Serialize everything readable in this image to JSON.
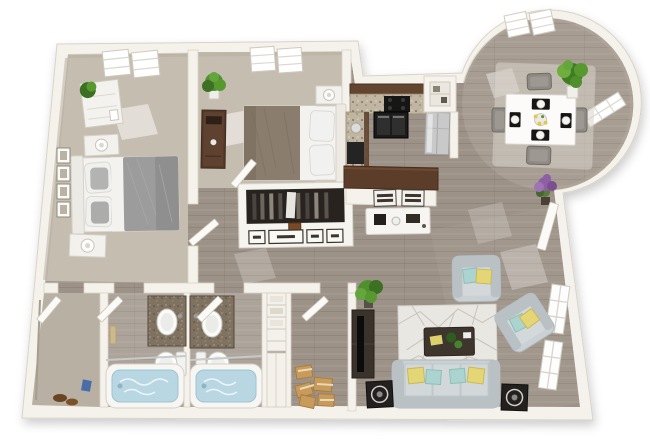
{
  "meta": {
    "description": "3D rendered bird's-eye floor plan of a two-bedroom, two-bathroom apartment with eat-in kitchen, round dining turret, hallway closets and living room",
    "render_style": "photoreal 3D dollhouse floor plan, no text labels"
  },
  "palette": {
    "wall-fill": "#f5f2ec",
    "wall-stroke": "#d9d3c8",
    "wall-face": "#b7afa1",
    "floor-wood": "#9d9287",
    "wood-line": "#837970",
    "carpet": "#c5bdaf",
    "carpet-dark": "#b8b0a2",
    "espresso": "#5b3d2a",
    "espresso-dark": "#452d1d",
    "granite": "#c0b5a0",
    "granite-dark": "#7f7260",
    "appliance-black": "#1b1b1b",
    "fridge-silver": "#c8c9c8",
    "fixture-white": "#fbfbf9",
    "tub-water": "#b9d7e2",
    "sofa": "#cad1d4",
    "sofa-dark": "#b9c1c5",
    "pillow-teal": "#abd3cf",
    "pillow-yellow": "#e4d677",
    "rug": "#e9e7e2",
    "rug-line": "#c7c3ba",
    "dark-furniture": "#3e362d",
    "bed-gray": "#9c9c9c",
    "bed-white": "#f4f3f0",
    "bed-taupe": "#8b7d6d",
    "plant-green": "#57992f",
    "plant-green-dark": "#3c7022",
    "plant-purple": "#8d5fa5",
    "door-white": "#fbfaf7",
    "box-tan": "#c89b5a"
  },
  "rooms": [
    {
      "id": "bedroom-1",
      "label": "Bedroom 1",
      "floor": "beige carpet",
      "features": [
        "queen bed with gray duvet",
        "two nightstands with lamps",
        "white dresser with plant",
        "four wall frames",
        "ceiling skylight",
        "sun patch"
      ]
    },
    {
      "id": "bedroom-2",
      "label": "Bedroom 2",
      "floor": "beige carpet",
      "features": [
        "queen bed with taupe duvet",
        "espresso wardrobe",
        "potted plant",
        "nightstands with lamps",
        "ceiling skylight"
      ]
    },
    {
      "id": "kitchen",
      "label": "Kitchen",
      "floor": "wood",
      "features": [
        "espresso cabinets",
        "granite counters",
        "black range",
        "stainless refrigerator",
        "pantry cubby",
        "breakfast peninsula"
      ]
    },
    {
      "id": "dining-turret",
      "label": "Round dining nook",
      "floor": "wood",
      "features": [
        "square white table",
        "four gray chairs",
        "black placemats with plates",
        "area rug",
        "tall green plant",
        "purple plant",
        "skylight",
        "curved window"
      ]
    },
    {
      "id": "living-room",
      "label": "Living room",
      "floor": "wood",
      "features": [
        "three-seat sofa",
        "two armchairs",
        "geometric rug",
        "dark coffee table",
        "TV console with TV",
        "two speakers",
        "green plant",
        "two windows"
      ]
    },
    {
      "id": "desk-nook",
      "label": "Desk nook",
      "floor": "wood",
      "features": [
        "white desk",
        "two chairs",
        "coffee machine"
      ]
    },
    {
      "id": "hall-closet",
      "label": "Hallway closet",
      "features": [
        "hanging clothes",
        "drawer unit"
      ]
    },
    {
      "id": "bathroom-1",
      "label": "Bathroom 1",
      "floor": "wood",
      "features": [
        "granite vanity with sink",
        "toilet",
        "tub with water",
        "towel"
      ]
    },
    {
      "id": "bathroom-2",
      "label": "Bathroom 2",
      "floor": "wood",
      "features": [
        "granite vanity with sink",
        "toilet",
        "tub with water"
      ]
    },
    {
      "id": "walk-in-closet",
      "label": "Walk-in closet",
      "floor": "carpet",
      "features": [
        "shoes",
        "bag"
      ]
    },
    {
      "id": "linen-closet",
      "label": "Linen closet",
      "features": [
        "shelves with linens"
      ]
    },
    {
      "id": "storage-room",
      "label": "Storage room",
      "floor": "wood",
      "features": [
        "cardboard boxes"
      ]
    },
    {
      "id": "entry",
      "label": "Entry",
      "features": [
        "open front door"
      ]
    }
  ]
}
